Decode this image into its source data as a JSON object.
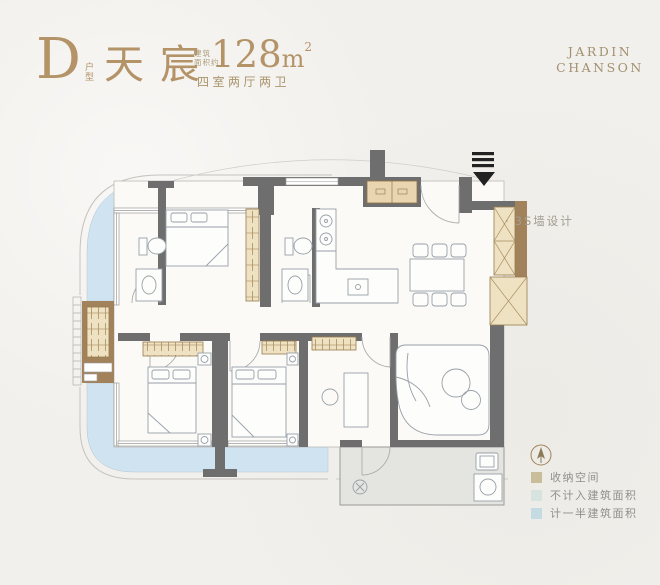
{
  "header": {
    "unit_letter": "D",
    "unit_type_label": "户型",
    "name": "天宸",
    "area_prefix_line1": "建筑",
    "area_prefix_line2": "面积约",
    "area_value": "128",
    "area_unit": "m",
    "area_superscript": "2",
    "rooms_summary": "四室两厅两卫"
  },
  "brand": {
    "line1": "JARDIN",
    "line2": "CHANSON"
  },
  "annotations": {
    "bullet": "·",
    "wall_note": "3S墙设计"
  },
  "legend": {
    "compass": "north-arrow",
    "items": [
      {
        "label": "收纳空间",
        "color": "#cabd9a"
      },
      {
        "label": "不计入建筑面积",
        "color": "#d6e3df"
      },
      {
        "label": "计一半建筑面积",
        "color": "#c5dbe2"
      }
    ]
  },
  "colors": {
    "background": "#f2f0ec",
    "accent_gold": "#b39367",
    "wall": "#6e6e6e",
    "storage_wall": "#a2825a",
    "storage_fill": "#efe2c3",
    "balcony_half_area": "#cfe3f1",
    "non_counted_area": "#e4e4e0"
  }
}
